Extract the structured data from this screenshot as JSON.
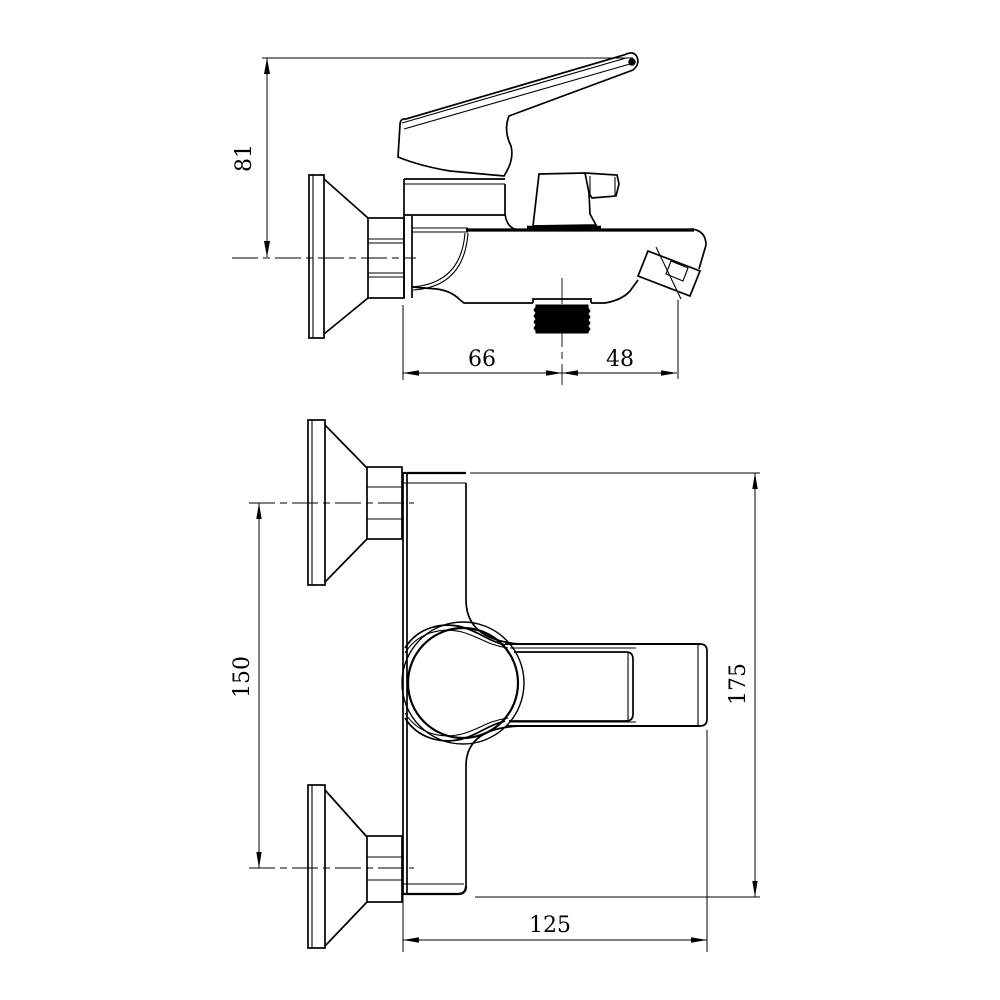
{
  "drawing": {
    "background": "#ffffff",
    "line_color": "#000000",
    "side_view": {
      "dim_handle_height": "81",
      "dim_wall_to_outlet": "66",
      "dim_outlet_to_spout_tip": "48"
    },
    "front_view": {
      "dim_mounting_centers": "150",
      "dim_overall_height": "175",
      "dim_overall_depth": "125"
    }
  }
}
